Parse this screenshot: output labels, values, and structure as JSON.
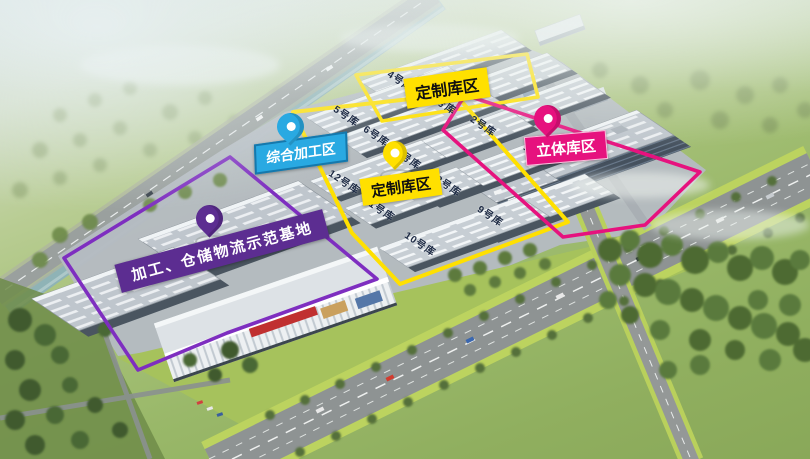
{
  "image_type": "aerial-rendering-of-logistics-park",
  "zones": {
    "custom_top": {
      "label": "定制库区",
      "color": "#FFE000",
      "text_color": "#101010"
    },
    "custom_main": {
      "label": "定制库区",
      "color": "#FFE000",
      "text_color": "#101010"
    },
    "processing": {
      "label": "综合加工区",
      "color": "#29A9E2",
      "text_color": "#FFFFFF"
    },
    "stereo": {
      "label": "立体库区",
      "color": "#E6127E",
      "text_color": "#FFFFFF"
    },
    "base": {
      "label": "加工、仓储物流示范基地",
      "color": "#5C2D91",
      "text_color": "#FFFFFF"
    }
  },
  "buildings": [
    {
      "name": "1号库"
    },
    {
      "name": "2号库"
    },
    {
      "name": "3号库"
    },
    {
      "name": "4号库"
    },
    {
      "name": "5号库"
    },
    {
      "name": "6号库"
    },
    {
      "name": "7号库"
    },
    {
      "name": "8号库"
    },
    {
      "name": "9号库"
    },
    {
      "name": "10号库"
    },
    {
      "name": "11号库"
    },
    {
      "name": "12号库"
    }
  ],
  "pins": [
    {
      "zone": "processing",
      "color": "#29A9E2"
    },
    {
      "zone": "custom_main",
      "color": "#FFE000"
    },
    {
      "zone": "stereo",
      "color": "#E6127E"
    },
    {
      "zone": "base",
      "color": "#5C2D91"
    }
  ]
}
